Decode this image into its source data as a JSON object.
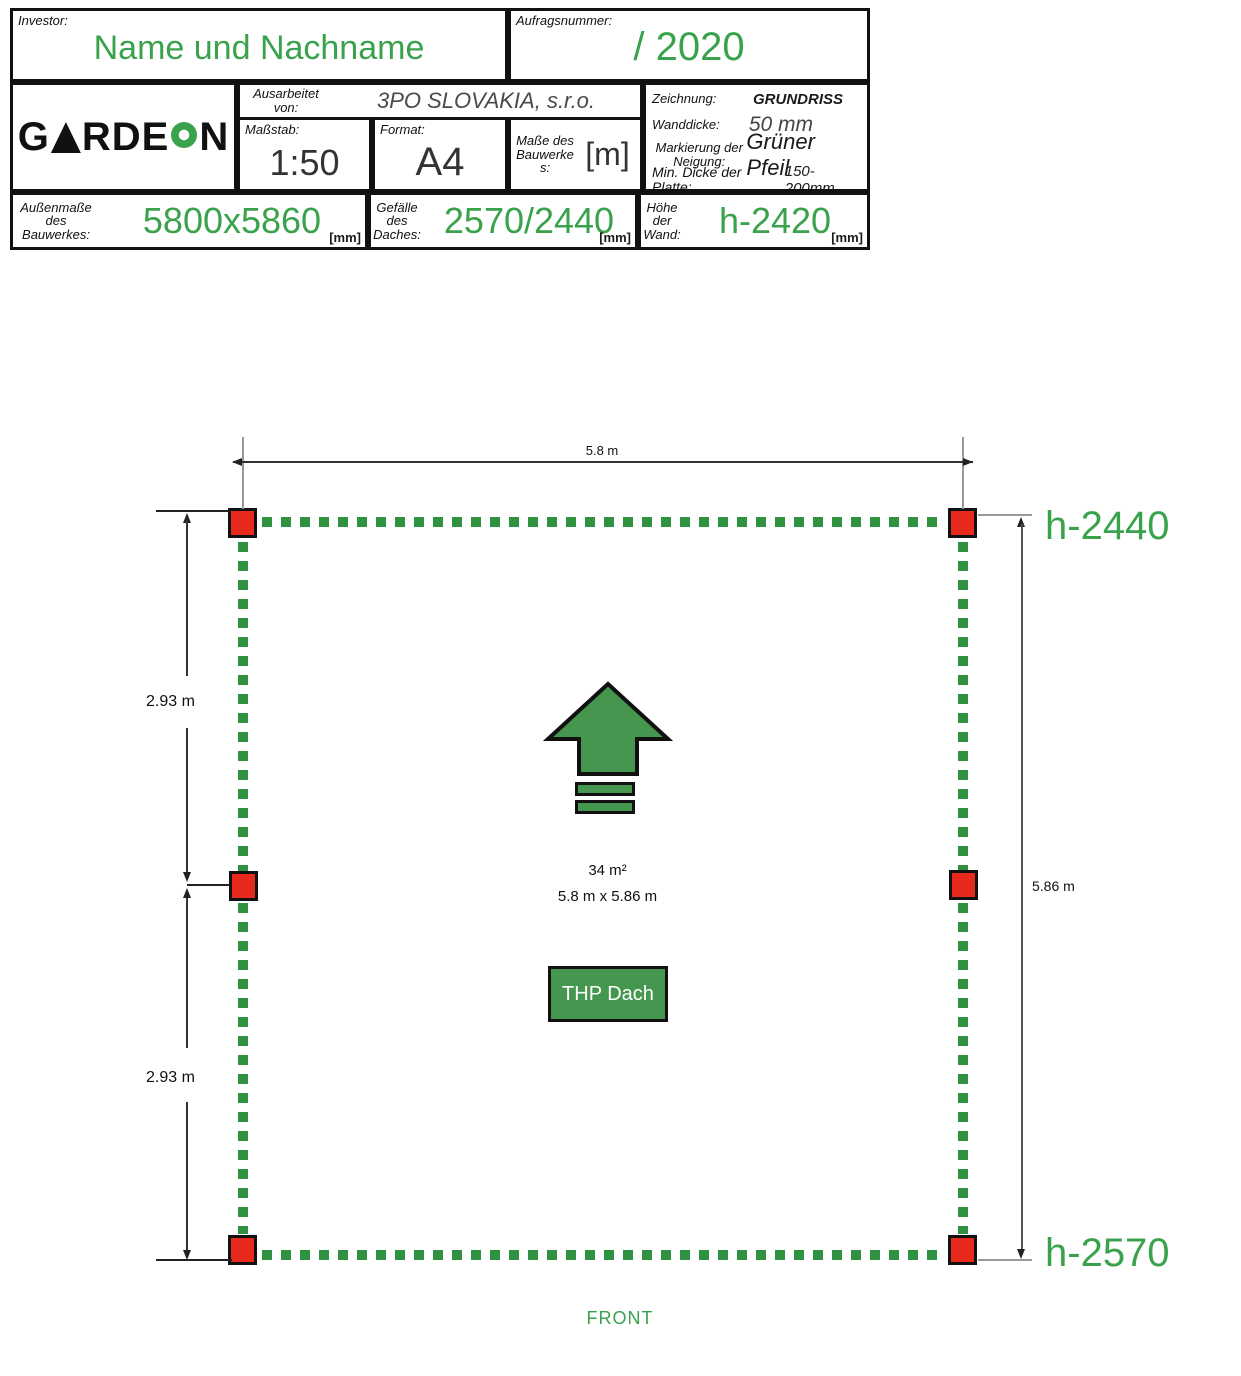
{
  "title_block": {
    "investor": {
      "label": "Investor:",
      "value": "Name und Nachname"
    },
    "aufragsnummer": {
      "label": "Aufragsnummer:",
      "value": "/ 2020"
    },
    "logo": {
      "part1": "G",
      "part2": "RDE",
      "part3": "N"
    },
    "ausarbeitet": {
      "label": "Ausarbeitet von:",
      "value": "3PO SLOVAKIA, s.r.o."
    },
    "massstab": {
      "label": "Maßstab:",
      "value": "1:50"
    },
    "format": {
      "label": "Format:",
      "value": "A4"
    },
    "masse": {
      "label": "Maße des Bauwerkes:",
      "value": "[m]"
    },
    "zeichnung": {
      "label": "Zeichnung:",
      "value": "GRUNDRISS"
    },
    "wanddicke": {
      "label": "Wanddicke:",
      "value": "50 mm"
    },
    "markierung": {
      "label": "Markierung der Neigung:",
      "value": "Grüner Pfeil"
    },
    "min_dicke": {
      "label": "Min. Dicke der Platte:",
      "value": "150-200mm"
    },
    "aussenmasse": {
      "label": "Außenmaße des Bauwerkes:",
      "value": "5800x5860",
      "unit": "[mm]"
    },
    "gefaelle": {
      "label": "Gefälle des Daches:",
      "value": "2570/2440",
      "unit": "[mm]"
    },
    "hoehe": {
      "label": "Höhe der Wand:",
      "value": "h-2420",
      "unit": "[mm]"
    }
  },
  "plan": {
    "dim_top": "5.8 m",
    "dim_left_upper": "2.93 m",
    "dim_left_lower": "2.93 m",
    "dim_right": "5.86 m",
    "h_top": "h-2440",
    "h_bottom": "h-2570",
    "area": "34 m²",
    "size": "5.8 m x 5.86 m",
    "roof_label": "THP Dach",
    "front_label": "FRONT"
  },
  "icons": {
    "logo_triangle": "triangle-a-icon",
    "logo_donut": "green-donut-o-icon",
    "slope_arrow": "green-up-arrow-icon"
  },
  "colors": {
    "accent_green": "#3aa24c",
    "dash_green": "#2f9241",
    "arrow_fill": "#45964e",
    "post_red": "#e8291d"
  }
}
